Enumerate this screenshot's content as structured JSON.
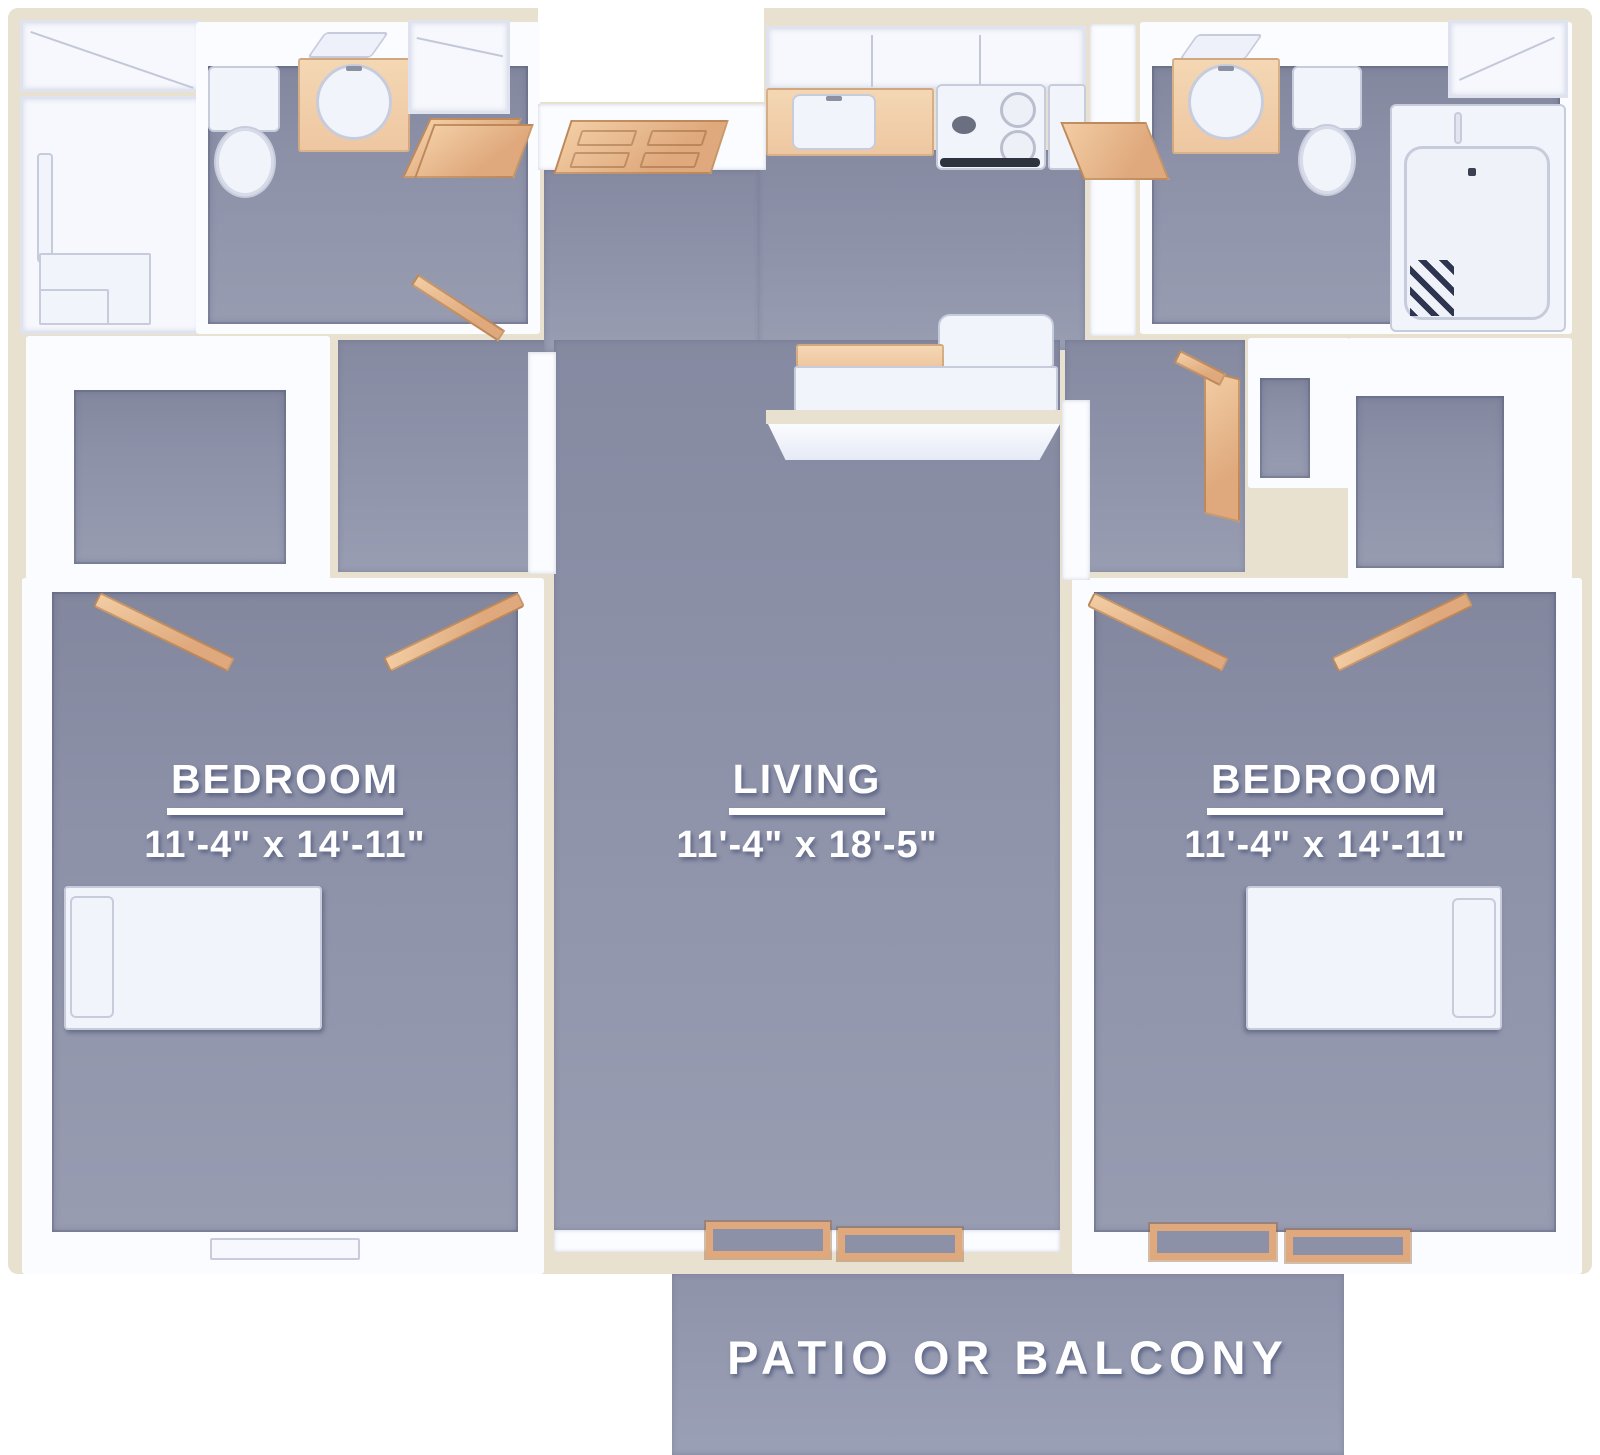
{
  "rooms": [
    {
      "id": "bedroom-left",
      "label": "BEDROOM",
      "dimensions": "11'-4\" x 14'-11\""
    },
    {
      "id": "living",
      "label": "LIVING",
      "dimensions": "11'-4\" x 18'-5\""
    },
    {
      "id": "bedroom-right",
      "label": "BEDROOM",
      "dimensions": "11'-4\" x 14'-11\""
    },
    {
      "id": "patio",
      "label": "PATIO OR BALCONY"
    }
  ],
  "fixtures": [
    "shower",
    "bench",
    "toilet",
    "vanity-sink",
    "mirror",
    "closet",
    "entry-door",
    "open-door",
    "upper-cabinets",
    "kitchen-counter",
    "kitchen-sink",
    "stove",
    "refrigerator",
    "breakfast-bar",
    "sofa",
    "bathtub",
    "bed",
    "pillow",
    "window",
    "sliding-patio-door"
  ],
  "colors": {
    "floor": "#8d91a8",
    "floorLight": "#9aa0b5",
    "wall": "#fbfcff",
    "exterior": "#e9e1cf",
    "door": "#dfa97d",
    "doorLight": "#f3cda4",
    "counter": "#eec7a1",
    "fixture": "#f2f4fb",
    "fixtureBorder": "#c7ccdd",
    "label": "#ffffff"
  }
}
